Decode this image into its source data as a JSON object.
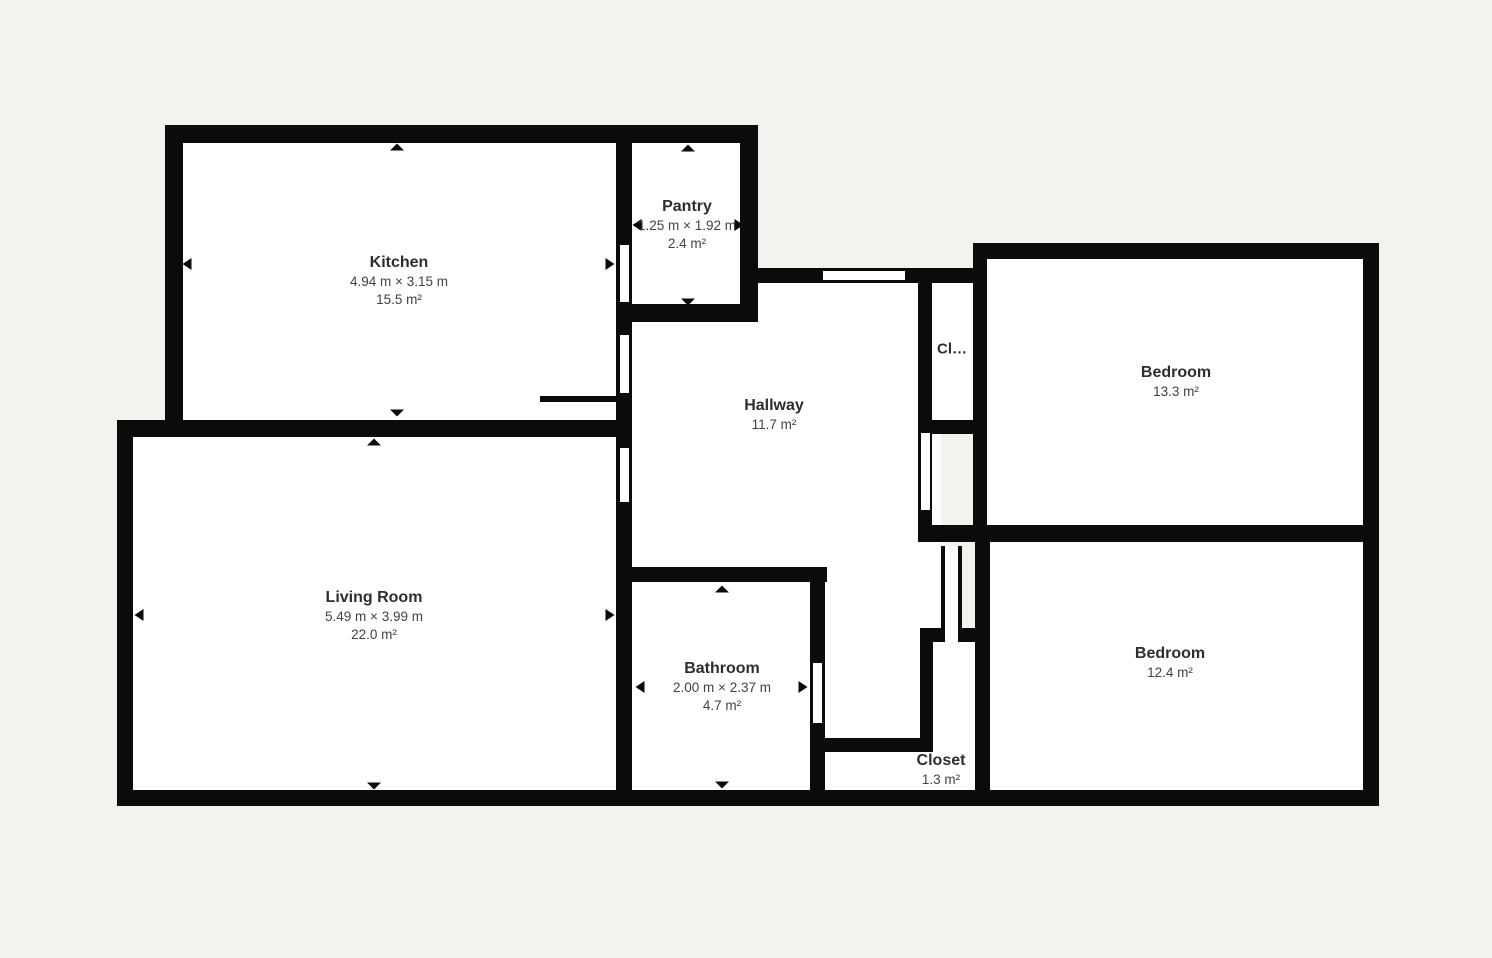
{
  "canvas": {
    "background_color": "#f4f2ef",
    "wall_color": "#0b0b0b",
    "room_fill_color": "#ffffff",
    "room_name_color": "#2e2e2e",
    "room_text_color": "#424242"
  },
  "icons": {
    "dimension-arrow-up": "▲",
    "dimension-arrow-down": "▼",
    "dimension-arrow-left": "◀",
    "dimension-arrow-right": "▶"
  },
  "rooms": [
    {
      "id": "kitchen",
      "name": "Kitchen",
      "dimensions": "4.94 m × 3.15 m",
      "area": "15.5 m²"
    },
    {
      "id": "pantry",
      "name": "Pantry",
      "dimensions": "1.25 m × 1.92 m",
      "area": "2.4 m²"
    },
    {
      "id": "hallway",
      "name": "Hallway",
      "area": "11.7 m²"
    },
    {
      "id": "closet-upper",
      "name": "Cl…"
    },
    {
      "id": "bedroom-1",
      "name": "Bedroom",
      "area": "13.3 m²"
    },
    {
      "id": "living-room",
      "name": "Living Room",
      "dimensions": "5.49 m × 3.99 m",
      "area": "22.0 m²"
    },
    {
      "id": "bathroom",
      "name": "Bathroom",
      "dimensions": "2.00 m × 2.37 m",
      "area": "4.7 m²"
    },
    {
      "id": "closet-lower",
      "name": "Closet",
      "area": "1.3 m²"
    },
    {
      "id": "bedroom-2",
      "name": "Bedroom",
      "area": "12.4 m²"
    }
  ]
}
